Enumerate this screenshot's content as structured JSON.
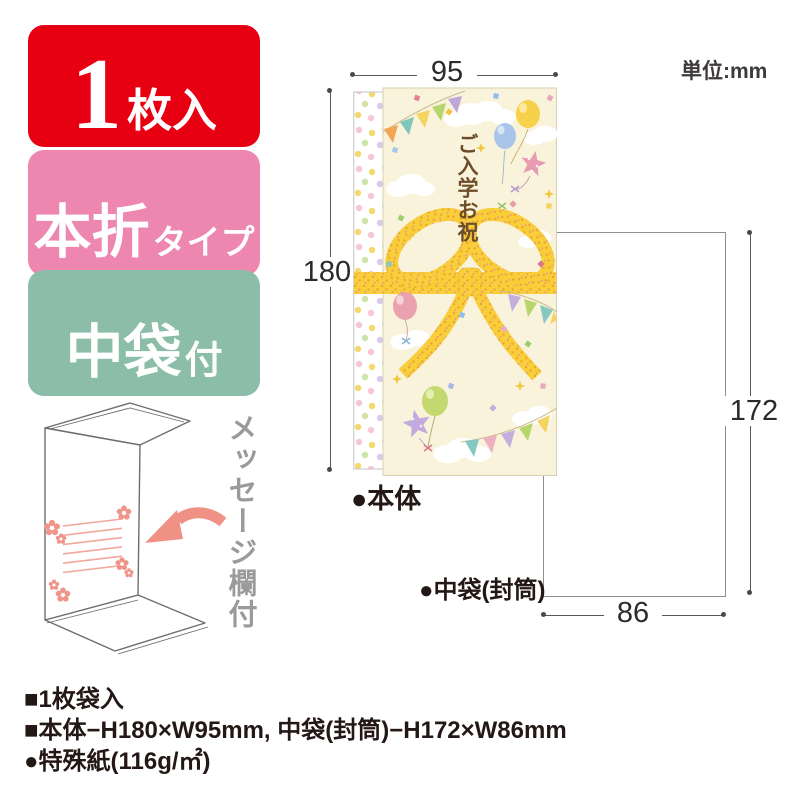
{
  "badges": {
    "count": {
      "number": "1",
      "suffix": "枚入",
      "bg": "#e60012"
    },
    "fold": {
      "main": "本折",
      "sub": "タイプ",
      "bg": "#ee87b0"
    },
    "inner": {
      "main": "中袋",
      "sub": "付",
      "bg": "#8cbda8"
    }
  },
  "unit_note": "単位:mm",
  "diagram": {
    "envelope_title": "ご入学お祝",
    "body_label": "●本体",
    "inner_label": "●中袋(封筒)",
    "dims": {
      "body_width": "95",
      "body_height": "180",
      "inner_height": "172",
      "inner_width": "86"
    }
  },
  "foldout": {
    "note": "メッセージ欄付"
  },
  "specs": {
    "lines": [
      "■1枚袋入",
      "■本体−H180×W95mm, 中袋(封筒)−H172×W86mm",
      "●特殊紙(116g/㎡)"
    ]
  },
  "colors": {
    "badge_red": "#e60012",
    "badge_pink": "#ee87b0",
    "badge_green": "#8cbda8",
    "ribbon_yellow": "#f8ce39",
    "ribbon_dot_orange": "#eda33b",
    "panel_cream": "#faf3dc",
    "arrow_pink": "#ef9185",
    "text_dark": "#231815",
    "dim_line_gray": "#595757",
    "title_brown": "#6d4e28"
  }
}
